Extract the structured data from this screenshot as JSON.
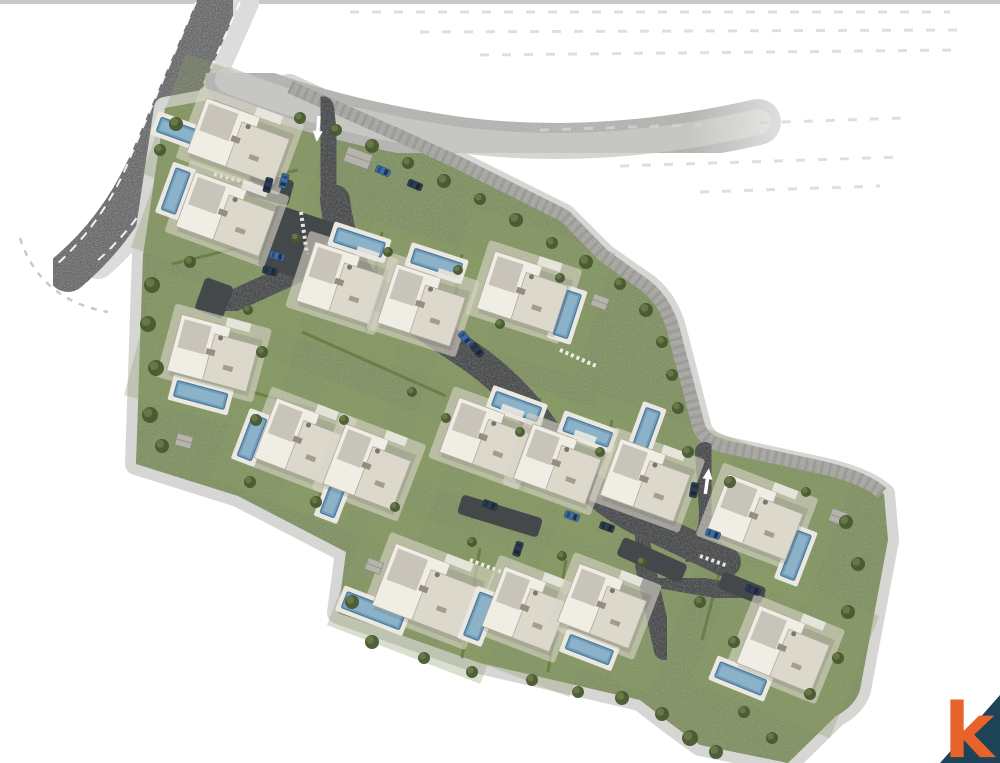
{
  "page": {
    "background": "#ffffff",
    "description": "aerial site master plan rendering of a villa estate"
  },
  "logo": {
    "letter": "k",
    "letter_color": "#e8632c",
    "triangle_color": "#1c4356"
  },
  "map": {
    "palette": {
      "topStrip": "#c8c8c6",
      "publicRoad": "#4b4e50",
      "publicSidewalk": "#dcdcda",
      "sidewalk": "#d6d6d4",
      "track": "#b3b3af",
      "trackInner": "#cbcbc7",
      "wall": "#a2a29d",
      "wallDark": "#8b8b86",
      "green": "#7d8f5a",
      "greenLight": "#8d9e66",
      "hedge": "#67783f",
      "road": "#3a3d3f",
      "pad": "#45484a",
      "apron": "#d9d5c8",
      "bldgMain": "#f0ede5",
      "bldgWing": "#dcd8cc",
      "bldgRoof": "#c8c4ba",
      "bldgLine": "#aeaba1",
      "furn": "#968e7c",
      "deck": "#eae8e0",
      "pool": "#6f9dbb",
      "poolDeep": "#4d7898",
      "poolLight": "#a9c8da",
      "tree": "#49592f",
      "treeLight": "#6d7f4c",
      "shed": "#b6b3ab",
      "shedLine": "#8f8c85",
      "hatch": "#d4d4d0",
      "navy": "#2c3c52",
      "blue": "#3c6ca6",
      "gray": "#6e747c",
      "white": "#ffffff"
    },
    "site_outline": "M165,108 L290,85 L400,135 L455,160 L565,215 L605,255 L648,285 Q670,303 677,335 L700,425 Q704,442 724,447 L822,468 Q866,478 884,494 L888,540 L860,690 Q855,706 836,716 L788,763 L700,745 Q668,722 640,700 L480,663 L338,613 L346,552 L238,496 L136,464 L143,255 Z",
    "wall_path": "M290,87 L400,136 L455,161 L565,216 L604,256 L646,286 Q668,304 675,336 L698,424 Q702,440 722,446 L820,467 Q864,477 882,493",
    "track_path": "M228,80 Q330,122 460,140 Q600,158 758,122",
    "public_road": {
      "path": "M218,2 L150,160 Q120,228 68,272",
      "width": 40,
      "sidewalk_path": "M242,2 L174,156 Q148,218 98,262",
      "sidewalk_width": 34,
      "dashes": [
        "M196,2 L130,158 Q104,222 55,266",
        "M240,2 L172,156 Q146,218 96,262"
      ],
      "outer_dash": "M20,238 Q40,300 108,312"
    },
    "internal_roads": [
      {
        "path": "M322,108 L335,222",
        "w": 24
      },
      {
        "path": "M335,200 Q342,258 368,288 L470,356 Q522,392 556,448 Q592,498 642,522 L726,562",
        "w": 30
      },
      {
        "path": "M332,256 L222,306",
        "w": 22
      },
      {
        "path": "M705,452 L709,510 Q710,545 688,552",
        "w": 20
      },
      {
        "path": "M638,534 L664,650",
        "w": 20
      },
      {
        "path": "M664,580 L756,596",
        "w": 18
      }
    ],
    "parking_pads": [
      [
        305,
        247,
        80,
        64,
        18
      ],
      [
        214,
        298,
        30,
        34,
        20
      ],
      [
        270,
        188,
        44,
        26,
        15
      ],
      [
        500,
        516,
        84,
        20,
        17
      ],
      [
        652,
        560,
        70,
        20,
        24
      ],
      [
        742,
        588,
        46,
        18,
        22
      ]
    ],
    "arrows": [
      {
        "x": 318,
        "y": 128,
        "rot": 185
      },
      {
        "x": 707,
        "y": 482,
        "rot": 8
      }
    ],
    "hatch_rows": [
      "M350,12 L950,12",
      "M420,32 L960,30",
      "M480,55 L960,50",
      "M540,130 L905,118",
      "M620,166 L900,157",
      "M700,192 L880,186"
    ],
    "hedges": [
      "M186,194 L298,170",
      "M172,264 L262,242",
      "M382,232 L366,332",
      "M462,254 L446,354",
      "M302,332 L446,396",
      "M340,416 L318,506",
      "M540,398 L522,490",
      "M612,420 L596,510",
      "M480,548 L462,658",
      "M566,560 L548,672",
      "M726,546 L702,640",
      "M252,392 L344,418"
    ],
    "walkways": [
      "M301,212 L307,254",
      "M214,174 L252,184",
      "M560,350 L596,366",
      "M470,560 L502,572",
      "M700,556 L728,566"
    ],
    "villas": [
      [
        240,
        141,
        20,
        92,
        58,
        -60,
        12,
        44,
        15
      ],
      [
        227,
        214,
        20,
        88,
        58,
        -56,
        -4,
        15,
        44
      ],
      [
        342,
        283,
        18,
        76,
        62,
        4,
        -44,
        50,
        15
      ],
      [
        423,
        305,
        18,
        76,
        62,
        0,
        -44,
        50,
        15
      ],
      [
        524,
        292,
        18,
        80,
        60,
        48,
        8,
        15,
        46
      ],
      [
        214,
        353,
        15,
        82,
        58,
        -2,
        44,
        52,
        16
      ],
      [
        300,
        441,
        21,
        74,
        64,
        -46,
        14,
        15,
        44
      ],
      [
        369,
        467,
        21,
        74,
        64,
        -22,
        38,
        15,
        44
      ],
      [
        486,
        438,
        20,
        78,
        58,
        18,
        -40,
        48,
        15
      ],
      [
        559,
        464,
        20,
        76,
        58,
        16,
        -40,
        48,
        15
      ],
      [
        647,
        480,
        20,
        78,
        60,
        -18,
        -46,
        15,
        44
      ],
      [
        757,
        517,
        21,
        84,
        60,
        50,
        22,
        15,
        48
      ],
      [
        428,
        591,
        21,
        94,
        66,
        -44,
        38,
        62,
        17
      ],
      [
        527,
        609,
        21,
        72,
        64,
        -42,
        24,
        16,
        46
      ],
      [
        604,
        606,
        21,
        76,
        62,
        2,
        46,
        46,
        15
      ],
      [
        785,
        649,
        22,
        80,
        62,
        -30,
        44,
        50,
        16
      ]
    ],
    "sheds": [
      [
        358,
        158,
        26,
        15,
        20
      ],
      [
        600,
        302,
        16,
        12,
        20
      ],
      [
        374,
        566,
        16,
        12,
        21
      ],
      [
        184,
        441,
        16,
        12,
        15
      ],
      [
        838,
        517,
        16,
        13,
        21
      ]
    ],
    "trees": [
      [
        176,
        124,
        7
      ],
      [
        160,
        150,
        6
      ],
      [
        300,
        118,
        6
      ],
      [
        336,
        130,
        6
      ],
      [
        372,
        146,
        7
      ],
      [
        408,
        163,
        6
      ],
      [
        444,
        181,
        7
      ],
      [
        480,
        199,
        6
      ],
      [
        516,
        220,
        7
      ],
      [
        552,
        243,
        6
      ],
      [
        586,
        262,
        7
      ],
      [
        620,
        284,
        6
      ],
      [
        646,
        310,
        7
      ],
      [
        662,
        342,
        6
      ],
      [
        672,
        375,
        6
      ],
      [
        678,
        408,
        6
      ],
      [
        152,
        285,
        8
      ],
      [
        148,
        324,
        8
      ],
      [
        156,
        368,
        8
      ],
      [
        150,
        415,
        8
      ],
      [
        162,
        446,
        7
      ],
      [
        190,
        262,
        6
      ],
      [
        248,
        310,
        5
      ],
      [
        262,
        352,
        6
      ],
      [
        256,
        420,
        6
      ],
      [
        250,
        482,
        6
      ],
      [
        316,
        502,
        6
      ],
      [
        296,
        238,
        5
      ],
      [
        388,
        252,
        5
      ],
      [
        458,
        270,
        5
      ],
      [
        560,
        278,
        5
      ],
      [
        500,
        324,
        5
      ],
      [
        344,
        420,
        5
      ],
      [
        412,
        392,
        5
      ],
      [
        446,
        418,
        5
      ],
      [
        520,
        432,
        5
      ],
      [
        600,
        452,
        5
      ],
      [
        688,
        452,
        6
      ],
      [
        730,
        482,
        6
      ],
      [
        806,
        492,
        5
      ],
      [
        846,
        522,
        7
      ],
      [
        858,
        564,
        7
      ],
      [
        848,
        612,
        7
      ],
      [
        838,
        658,
        6
      ],
      [
        810,
        694,
        6
      ],
      [
        352,
        602,
        7
      ],
      [
        372,
        642,
        7
      ],
      [
        424,
        658,
        6
      ],
      [
        472,
        672,
        6
      ],
      [
        532,
        680,
        6
      ],
      [
        578,
        692,
        6
      ],
      [
        622,
        698,
        7
      ],
      [
        662,
        714,
        7
      ],
      [
        690,
        738,
        8
      ],
      [
        716,
        752,
        7
      ],
      [
        744,
        712,
        6
      ],
      [
        772,
        738,
        6
      ],
      [
        700,
        602,
        6
      ],
      [
        734,
        642,
        6
      ],
      [
        472,
        542,
        5
      ],
      [
        562,
        556,
        5
      ],
      [
        642,
        562,
        5
      ],
      [
        395,
        507,
        5
      ]
    ],
    "cars": [
      [
        268,
        185,
        105,
        "navy"
      ],
      [
        284,
        181,
        105,
        "blue"
      ],
      [
        383,
        171,
        23,
        "blue"
      ],
      [
        415,
        185,
        23,
        "navy"
      ],
      [
        277,
        256,
        15,
        "blue"
      ],
      [
        270,
        271,
        15,
        "navy"
      ],
      [
        465,
        338,
        50,
        "blue"
      ],
      [
        477,
        350,
        50,
        "navy"
      ],
      [
        490,
        505,
        20,
        "navy"
      ],
      [
        572,
        516,
        20,
        "blue"
      ],
      [
        607,
        527,
        20,
        "navy"
      ],
      [
        518,
        549,
        108,
        "navy"
      ],
      [
        694,
        490,
        100,
        "navy"
      ],
      [
        713,
        534,
        20,
        "blue"
      ],
      [
        753,
        590,
        22,
        "navy"
      ]
    ]
  }
}
